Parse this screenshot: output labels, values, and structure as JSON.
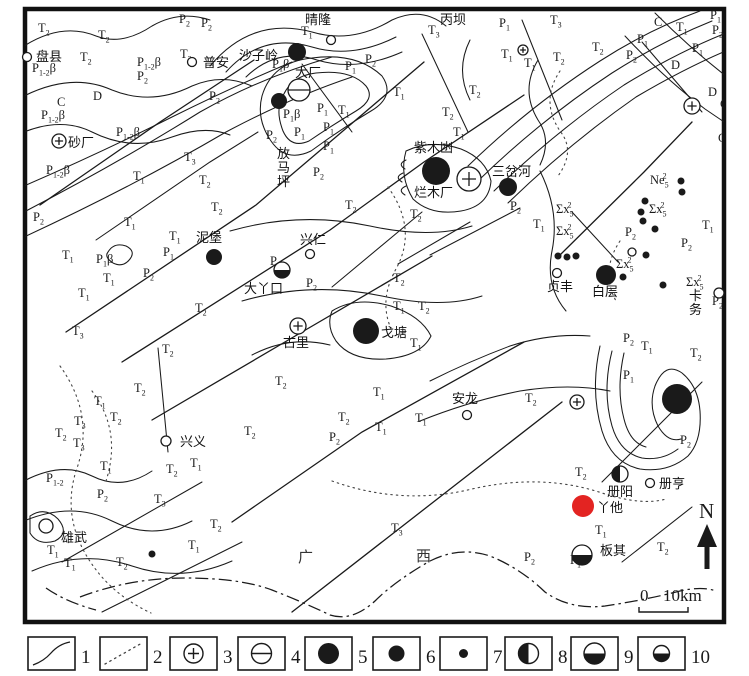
{
  "colors": {
    "ink": "#1a1a1a",
    "red": "#e32422",
    "paper": "#ffffff"
  },
  "map": {
    "north_label": "N",
    "scale_bar": {
      "zero": "0",
      "distance": "10km"
    },
    "province_label": {
      "guang": "广",
      "xi": "西"
    },
    "unit_labels": [
      {
        "m": "T",
        "b": "2",
        "x": 38,
        "y": 32
      },
      {
        "m": "T",
        "b": "2",
        "x": 98,
        "y": 39
      },
      {
        "m": "P",
        "b": "2",
        "x": 179,
        "y": 23
      },
      {
        "m": "P",
        "b": "2",
        "x": 201,
        "y": 27
      },
      {
        "m": "T",
        "b": "2",
        "x": 80,
        "y": 61
      },
      {
        "m": "T",
        "b": "2",
        "x": 180,
        "y": 58
      },
      {
        "m": "P",
        "b": "1-2",
        "a": "β",
        "x": 32,
        "y": 72
      },
      {
        "m": "P",
        "b": "1-2",
        "a": "β",
        "x": 137,
        "y": 66
      },
      {
        "m": "P",
        "b": "2",
        "x": 137,
        "y": 80
      },
      {
        "m": "C",
        "x": 57,
        "y": 106
      },
      {
        "m": "D",
        "x": 93,
        "y": 100
      },
      {
        "m": "P",
        "b": "2",
        "x": 209,
        "y": 100
      },
      {
        "m": "P",
        "b": "1-2",
        "a": "β",
        "x": 41,
        "y": 119
      },
      {
        "m": "P",
        "b": "1-2",
        "a": "β",
        "x": 116,
        "y": 136
      },
      {
        "m": "T",
        "b": "3",
        "x": 184,
        "y": 161
      },
      {
        "m": "P",
        "b": "1-2",
        "a": "β",
        "x": 46,
        "y": 174
      },
      {
        "m": "T",
        "b": "1",
        "x": 133,
        "y": 180
      },
      {
        "m": "T",
        "b": "2",
        "x": 199,
        "y": 184
      },
      {
        "m": "T",
        "b": "2",
        "x": 211,
        "y": 211
      },
      {
        "m": "P",
        "b": "2",
        "x": 33,
        "y": 221
      },
      {
        "m": "T",
        "b": "1",
        "x": 124,
        "y": 226
      },
      {
        "m": "T",
        "b": "1",
        "x": 169,
        "y": 240
      },
      {
        "m": "T",
        "b": "1",
        "x": 62,
        "y": 259
      },
      {
        "m": "P",
        "b": "1",
        "a": "β",
        "x": 96,
        "y": 263
      },
      {
        "m": "P",
        "b": "1",
        "x": 163,
        "y": 256
      },
      {
        "m": "P",
        "b": "2",
        "x": 143,
        "y": 277
      },
      {
        "m": "T",
        "b": "1",
        "x": 103,
        "y": 282
      },
      {
        "m": "T",
        "b": "1",
        "x": 78,
        "y": 297
      },
      {
        "m": "T",
        "b": "2",
        "x": 195,
        "y": 312
      },
      {
        "m": "T",
        "b": "1",
        "x": 301,
        "y": 35
      },
      {
        "m": "T",
        "b": "3",
        "x": 428,
        "y": 34
      },
      {
        "m": "P",
        "b": "1",
        "a": "β",
        "x": 272,
        "y": 68
      },
      {
        "m": "P",
        "b": "1",
        "x": 345,
        "y": 70
      },
      {
        "m": "P",
        "b": "2",
        "x": 365,
        "y": 63
      },
      {
        "m": "P",
        "b": "1",
        "a": "β",
        "x": 283,
        "y": 118
      },
      {
        "m": "P",
        "b": "1",
        "x": 317,
        "y": 112
      },
      {
        "m": "T",
        "b": "1",
        "x": 338,
        "y": 114
      },
      {
        "m": "P",
        "b": "2",
        "x": 266,
        "y": 139
      },
      {
        "m": "P",
        "b": "1",
        "x": 294,
        "y": 136
      },
      {
        "m": "P",
        "b": "1",
        "x": 323,
        "y": 131
      },
      {
        "m": "P",
        "b": "1",
        "x": 323,
        "y": 150
      },
      {
        "m": "P",
        "b": "2",
        "x": 313,
        "y": 176
      },
      {
        "m": "T",
        "b": "1",
        "x": 393,
        "y": 96
      },
      {
        "m": "T",
        "b": "2",
        "x": 469,
        "y": 94
      },
      {
        "m": "T",
        "b": "2",
        "x": 442,
        "y": 116
      },
      {
        "m": "T",
        "b": "1",
        "x": 453,
        "y": 136
      },
      {
        "m": "P",
        "b": "2",
        "x": 510,
        "y": 210
      },
      {
        "m": "T",
        "b": "2",
        "x": 345,
        "y": 209
      },
      {
        "m": "T",
        "b": "2",
        "x": 410,
        "y": 218
      },
      {
        "m": "T",
        "b": "1",
        "x": 533,
        "y": 228
      },
      {
        "m": "P",
        "b": "1",
        "x": 499,
        "y": 27
      },
      {
        "m": "T",
        "b": "3",
        "x": 550,
        "y": 24
      },
      {
        "m": "T",
        "b": "1",
        "x": 501,
        "y": 58
      },
      {
        "m": "T",
        "b": "1",
        "x": 524,
        "y": 67
      },
      {
        "m": "T",
        "b": "2",
        "x": 553,
        "y": 61
      },
      {
        "m": "T",
        "b": "2",
        "x": 592,
        "y": 51
      },
      {
        "m": "C",
        "x": 654,
        "y": 26
      },
      {
        "m": "T",
        "b": "1",
        "x": 676,
        "y": 31
      },
      {
        "m": "P",
        "b": "1",
        "x": 710,
        "y": 19
      },
      {
        "m": "P",
        "b": "2",
        "x": 712,
        "y": 34
      },
      {
        "m": "P",
        "b": "1",
        "x": 637,
        "y": 43
      },
      {
        "m": "P",
        "b": "2",
        "x": 626,
        "y": 59
      },
      {
        "m": "P",
        "b": "1",
        "x": 692,
        "y": 52
      },
      {
        "m": "D",
        "x": 671,
        "y": 69
      },
      {
        "m": "D",
        "x": 708,
        "y": 96
      },
      {
        "m": "C",
        "x": 720,
        "y": 108
      },
      {
        "m": "C",
        "x": 718,
        "y": 142
      },
      {
        "m": "Σx",
        "b": "5",
        "p": "2",
        "x": 556,
        "y": 213
      },
      {
        "m": "Σx",
        "b": "5",
        "p": "2",
        "x": 556,
        "y": 235
      },
      {
        "m": "Σx",
        "b": "5",
        "p": "2",
        "x": 649,
        "y": 213
      },
      {
        "m": "Ne",
        "b": "5",
        "p": "2",
        "x": 650,
        "y": 184
      },
      {
        "m": "Σx",
        "b": "5",
        "p": "2",
        "x": 616,
        "y": 268
      },
      {
        "m": "Σx",
        "b": "5",
        "p": "2",
        "x": 686,
        "y": 286
      },
      {
        "m": "P",
        "b": "2",
        "x": 625,
        "y": 236
      },
      {
        "m": "T",
        "b": "1",
        "x": 702,
        "y": 229
      },
      {
        "m": "P",
        "b": "2",
        "x": 681,
        "y": 247
      },
      {
        "m": "P",
        "b": "2",
        "x": 712,
        "y": 305
      },
      {
        "m": "T",
        "b": "3",
        "x": 72,
        "y": 335
      },
      {
        "m": "T",
        "b": "2",
        "x": 162,
        "y": 353
      },
      {
        "m": "T",
        "b": "2",
        "x": 134,
        "y": 392
      },
      {
        "m": "T",
        "b": "1",
        "x": 94,
        "y": 405
      },
      {
        "m": "T",
        "b": "2",
        "x": 110,
        "y": 421
      },
      {
        "m": "T",
        "b": "3",
        "x": 74,
        "y": 425
      },
      {
        "m": "T",
        "b": "2",
        "x": 55,
        "y": 437
      },
      {
        "m": "T",
        "b": "3",
        "x": 73,
        "y": 447
      },
      {
        "m": "T",
        "b": "2",
        "x": 244,
        "y": 435
      },
      {
        "m": "P",
        "b": "1-2",
        "x": 46,
        "y": 482
      },
      {
        "m": "P",
        "b": "2",
        "x": 97,
        "y": 498
      },
      {
        "m": "T",
        "b": "1",
        "x": 100,
        "y": 470
      },
      {
        "m": "T",
        "b": "2",
        "x": 166,
        "y": 473
      },
      {
        "m": "T",
        "b": "1",
        "x": 190,
        "y": 467
      },
      {
        "m": "T",
        "b": "3",
        "x": 154,
        "y": 503
      },
      {
        "m": "T",
        "b": "1",
        "x": 47,
        "y": 554
      },
      {
        "m": "T",
        "b": "1",
        "x": 64,
        "y": 567
      },
      {
        "m": "T",
        "b": "2",
        "x": 116,
        "y": 566
      },
      {
        "m": "T",
        "b": "2",
        "x": 210,
        "y": 528
      },
      {
        "m": "T",
        "b": "1",
        "x": 188,
        "y": 549
      },
      {
        "m": "T",
        "b": "2",
        "x": 275,
        "y": 385
      },
      {
        "m": "T",
        "b": "1",
        "x": 373,
        "y": 396
      },
      {
        "m": "T",
        "b": "2",
        "x": 338,
        "y": 421
      },
      {
        "m": "P",
        "b": "2",
        "x": 329,
        "y": 441
      },
      {
        "m": "T",
        "b": "1",
        "x": 375,
        "y": 431
      },
      {
        "m": "T",
        "b": "1",
        "x": 415,
        "y": 422
      },
      {
        "m": "T",
        "b": "3",
        "x": 391,
        "y": 532
      },
      {
        "m": "P",
        "b": "2",
        "x": 270,
        "y": 265
      },
      {
        "m": "P",
        "b": "2",
        "x": 306,
        "y": 287
      },
      {
        "m": "T",
        "b": "2",
        "x": 393,
        "y": 282
      },
      {
        "m": "T",
        "b": "1",
        "x": 393,
        "y": 310
      },
      {
        "m": "T",
        "b": "2",
        "x": 418,
        "y": 310
      },
      {
        "m": "T",
        "b": "1",
        "x": 410,
        "y": 347
      },
      {
        "m": "T",
        "b": "2",
        "x": 525,
        "y": 402
      },
      {
        "m": "P",
        "b": "2",
        "x": 623,
        "y": 342
      },
      {
        "m": "T",
        "b": "1",
        "x": 641,
        "y": 350
      },
      {
        "m": "T",
        "b": "2",
        "x": 690,
        "y": 357
      },
      {
        "m": "P",
        "b": "1",
        "x": 623,
        "y": 379
      },
      {
        "m": "P",
        "b": "2",
        "x": 680,
        "y": 444
      },
      {
        "m": "T",
        "b": "2",
        "x": 575,
        "y": 476
      },
      {
        "m": "T",
        "b": "1",
        "x": 595,
        "y": 534
      },
      {
        "m": "P",
        "b": "2",
        "x": 524,
        "y": 561
      },
      {
        "m": "P",
        "b": "1",
        "x": 570,
        "y": 564
      },
      {
        "m": "T",
        "b": "2",
        "x": 657,
        "y": 551
      }
    ],
    "place_labels": [
      {
        "name": "盘县",
        "x": 36,
        "y": 61,
        "vertical": false
      },
      {
        "name": "普安",
        "x": 203,
        "y": 67,
        "vertical": false
      },
      {
        "name": "晴隆",
        "x": 305,
        "y": 24,
        "vertical": false
      },
      {
        "name": "丙坝",
        "x": 440,
        "y": 24,
        "vertical": false
      },
      {
        "name": "沙子岭",
        "x": 239,
        "y": 60,
        "vertical": false
      },
      {
        "name": "大厂",
        "x": 295,
        "y": 77,
        "vertical": false
      },
      {
        "name": "砂厂",
        "x": 68,
        "y": 147,
        "vertical": false
      },
      {
        "name": "放马坪",
        "x": 277,
        "y": 158,
        "vertical": true
      },
      {
        "name": "紫木凼",
        "x": 414,
        "y": 152,
        "vertical": false
      },
      {
        "name": "烂木厂",
        "x": 414,
        "y": 197,
        "vertical": false
      },
      {
        "name": "三岔河",
        "x": 492,
        "y": 176,
        "vertical": false
      },
      {
        "name": "泥堡",
        "x": 196,
        "y": 242,
        "vertical": false
      },
      {
        "name": "兴仁",
        "x": 300,
        "y": 244,
        "vertical": false
      },
      {
        "name": "大丫口",
        "x": 244,
        "y": 293,
        "vertical": false
      },
      {
        "name": "贞丰",
        "x": 547,
        "y": 291,
        "vertical": false
      },
      {
        "name": "白层",
        "x": 592,
        "y": 296,
        "vertical": false
      },
      {
        "name": "卡务",
        "x": 689,
        "y": 300,
        "vertical": true
      },
      {
        "name": "古里",
        "x": 283,
        "y": 347,
        "vertical": false
      },
      {
        "name": "戈塘",
        "x": 381,
        "y": 337,
        "vertical": false
      },
      {
        "name": "兴义",
        "x": 180,
        "y": 446,
        "vertical": false
      },
      {
        "name": "安龙",
        "x": 452,
        "y": 403,
        "vertical": false
      },
      {
        "name": "雄武",
        "x": 61,
        "y": 542,
        "vertical": false
      },
      {
        "name": "册阳",
        "x": 607,
        "y": 496,
        "vertical": false
      },
      {
        "name": "册亨",
        "x": 659,
        "y": 488,
        "vertical": false
      },
      {
        "name": "丫他",
        "x": 597,
        "y": 512,
        "vertical": false
      },
      {
        "name": "板其",
        "x": 600,
        "y": 555,
        "vertical": false
      }
    ],
    "markers": [
      {
        "t": "town",
        "x": 27,
        "y": 57,
        "r": 4.5
      },
      {
        "t": "town",
        "x": 192,
        "y": 62,
        "r": 4.5
      },
      {
        "t": "town",
        "x": 331,
        "y": 40,
        "r": 4.5
      },
      {
        "t": "town",
        "x": 310,
        "y": 254,
        "r": 4.5
      },
      {
        "t": "town",
        "x": 557,
        "y": 273,
        "r": 4.5
      },
      {
        "t": "town",
        "x": 166,
        "y": 441,
        "r": 5
      },
      {
        "t": "town",
        "x": 467,
        "y": 415,
        "r": 4.5
      },
      {
        "t": "town",
        "x": 46,
        "y": 526,
        "r": 7
      },
      {
        "t": "town",
        "x": 650,
        "y": 483,
        "r": 4.5
      },
      {
        "t": "open",
        "x": 632,
        "y": 252,
        "r": 4
      },
      {
        "t": "open",
        "x": 719,
        "y": 293,
        "r": 5
      },
      {
        "t": "plus",
        "x": 59,
        "y": 141,
        "r": 7
      },
      {
        "t": "plus",
        "x": 298,
        "y": 326,
        "r": 8
      },
      {
        "t": "plus",
        "x": 469,
        "y": 179,
        "r": 12
      },
      {
        "t": "plus",
        "x": 692,
        "y": 106,
        "r": 8
      },
      {
        "t": "plus",
        "x": 577,
        "y": 402,
        "r": 7
      },
      {
        "t": "plus",
        "x": 523,
        "y": 50,
        "r": 5
      },
      {
        "t": "bar",
        "x": 299,
        "y": 90,
        "r": 11
      },
      {
        "t": "dot",
        "x": 436,
        "y": 171,
        "r": 14
      },
      {
        "t": "dot",
        "x": 366,
        "y": 331,
        "r": 13
      },
      {
        "t": "dot",
        "x": 677,
        "y": 399,
        "r": 15
      },
      {
        "t": "dot",
        "x": 297,
        "y": 52,
        "r": 9
      },
      {
        "t": "dot",
        "x": 279,
        "y": 101,
        "r": 8
      },
      {
        "t": "dot",
        "x": 508,
        "y": 187,
        "r": 9
      },
      {
        "t": "dot",
        "x": 214,
        "y": 257,
        "r": 8
      },
      {
        "t": "dot",
        "x": 606,
        "y": 275,
        "r": 10
      },
      {
        "t": "dot",
        "x": 558,
        "y": 256,
        "r": 3.5
      },
      {
        "t": "dot",
        "x": 567,
        "y": 257,
        "r": 3.5
      },
      {
        "t": "dot",
        "x": 576,
        "y": 256,
        "r": 3.5
      },
      {
        "t": "dot",
        "x": 681,
        "y": 181,
        "r": 3.5
      },
      {
        "t": "dot",
        "x": 682,
        "y": 192,
        "r": 3.5
      },
      {
        "t": "dot",
        "x": 645,
        "y": 201,
        "r": 3.5
      },
      {
        "t": "dot",
        "x": 641,
        "y": 212,
        "r": 3.5
      },
      {
        "t": "dot",
        "x": 643,
        "y": 221,
        "r": 3.5
      },
      {
        "t": "dot",
        "x": 655,
        "y": 229,
        "r": 3.5
      },
      {
        "t": "dot",
        "x": 646,
        "y": 255,
        "r": 3.5
      },
      {
        "t": "dot",
        "x": 623,
        "y": 277,
        "r": 3.5
      },
      {
        "t": "dot",
        "x": 663,
        "y": 285,
        "r": 3.5
      },
      {
        "t": "dot",
        "x": 152,
        "y": 554,
        "r": 3.5
      },
      {
        "t": "half-left",
        "x": 620,
        "y": 474,
        "r": 8
      },
      {
        "t": "half-bottom",
        "x": 582,
        "y": 555,
        "r": 10
      },
      {
        "t": "half-bottom",
        "x": 282,
        "y": 270,
        "r": 8
      },
      {
        "t": "red",
        "x": 583,
        "y": 506,
        "r": 11
      }
    ]
  },
  "legend": {
    "items": [
      {
        "num": "1",
        "symbol": "curve"
      },
      {
        "num": "2",
        "symbol": "dots"
      },
      {
        "num": "3",
        "symbol": "plus"
      },
      {
        "num": "4",
        "symbol": "bar"
      },
      {
        "num": "5",
        "symbol": "dot-l"
      },
      {
        "num": "6",
        "symbol": "dot-m"
      },
      {
        "num": "7",
        "symbol": "dot-s"
      },
      {
        "num": "8",
        "symbol": "half-left"
      },
      {
        "num": "9",
        "symbol": "half-bottom-l"
      },
      {
        "num": "10",
        "symbol": "half-bottom-s"
      }
    ]
  }
}
